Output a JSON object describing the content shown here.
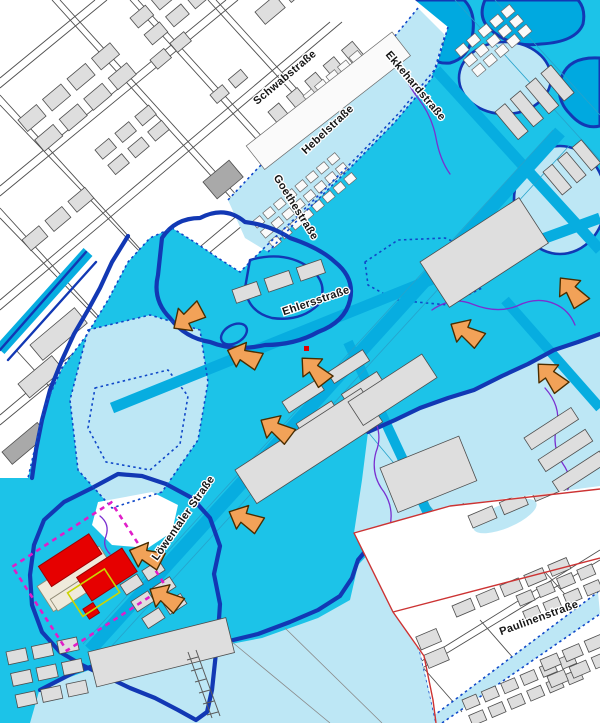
{
  "streets": [
    {
      "id": "schwabstrasse",
      "label": "Schwabstraße"
    },
    {
      "id": "ekkehardstrasse",
      "label": "Ekkehardstraße"
    },
    {
      "id": "hebelstrasse",
      "label": "Hebelstraße"
    },
    {
      "id": "goethestrasse",
      "label": "Goethestraße"
    },
    {
      "id": "ehlersstrasse",
      "label": "Ehlersstraße"
    },
    {
      "id": "loewentaler-strasse",
      "label": "Löwentaler Straße"
    },
    {
      "id": "paulinenstrasse",
      "label": "Paulinenstraße"
    }
  ],
  "arrows": [
    {
      "x": 190,
      "y": 317,
      "rot": -35
    },
    {
      "x": 246,
      "y": 357,
      "rot": 20
    },
    {
      "x": 316,
      "y": 372,
      "rot": 45
    },
    {
      "x": 278,
      "y": 430,
      "rot": 30
    },
    {
      "x": 468,
      "y": 334,
      "rot": 30
    },
    {
      "x": 573,
      "y": 293,
      "rot": 50
    },
    {
      "x": 552,
      "y": 378,
      "rot": 45
    },
    {
      "x": 247,
      "y": 520,
      "rot": 25
    },
    {
      "x": 148,
      "y": 557,
      "rot": 20
    },
    {
      "x": 167,
      "y": 599,
      "rot": 30
    }
  ],
  "site": {
    "highlighted_building_count": 3
  },
  "colors": {
    "flood_light": "#bde7f5",
    "flood_medium": "#1cc3e8",
    "flood_deep": "#00a9e0",
    "flood_street": "#07ade0",
    "outline_navy": "#1238b4",
    "boundary_dotted": "#1048c8",
    "purple_line": "#7a2fd0",
    "arrow_fill": "#f2a258",
    "site_red": "#e60000",
    "site_boundary_magenta": "#e01ec8",
    "planning_red_line": "#cc3333",
    "building_gray": "#dedede",
    "building_cream": "#efeadb"
  }
}
